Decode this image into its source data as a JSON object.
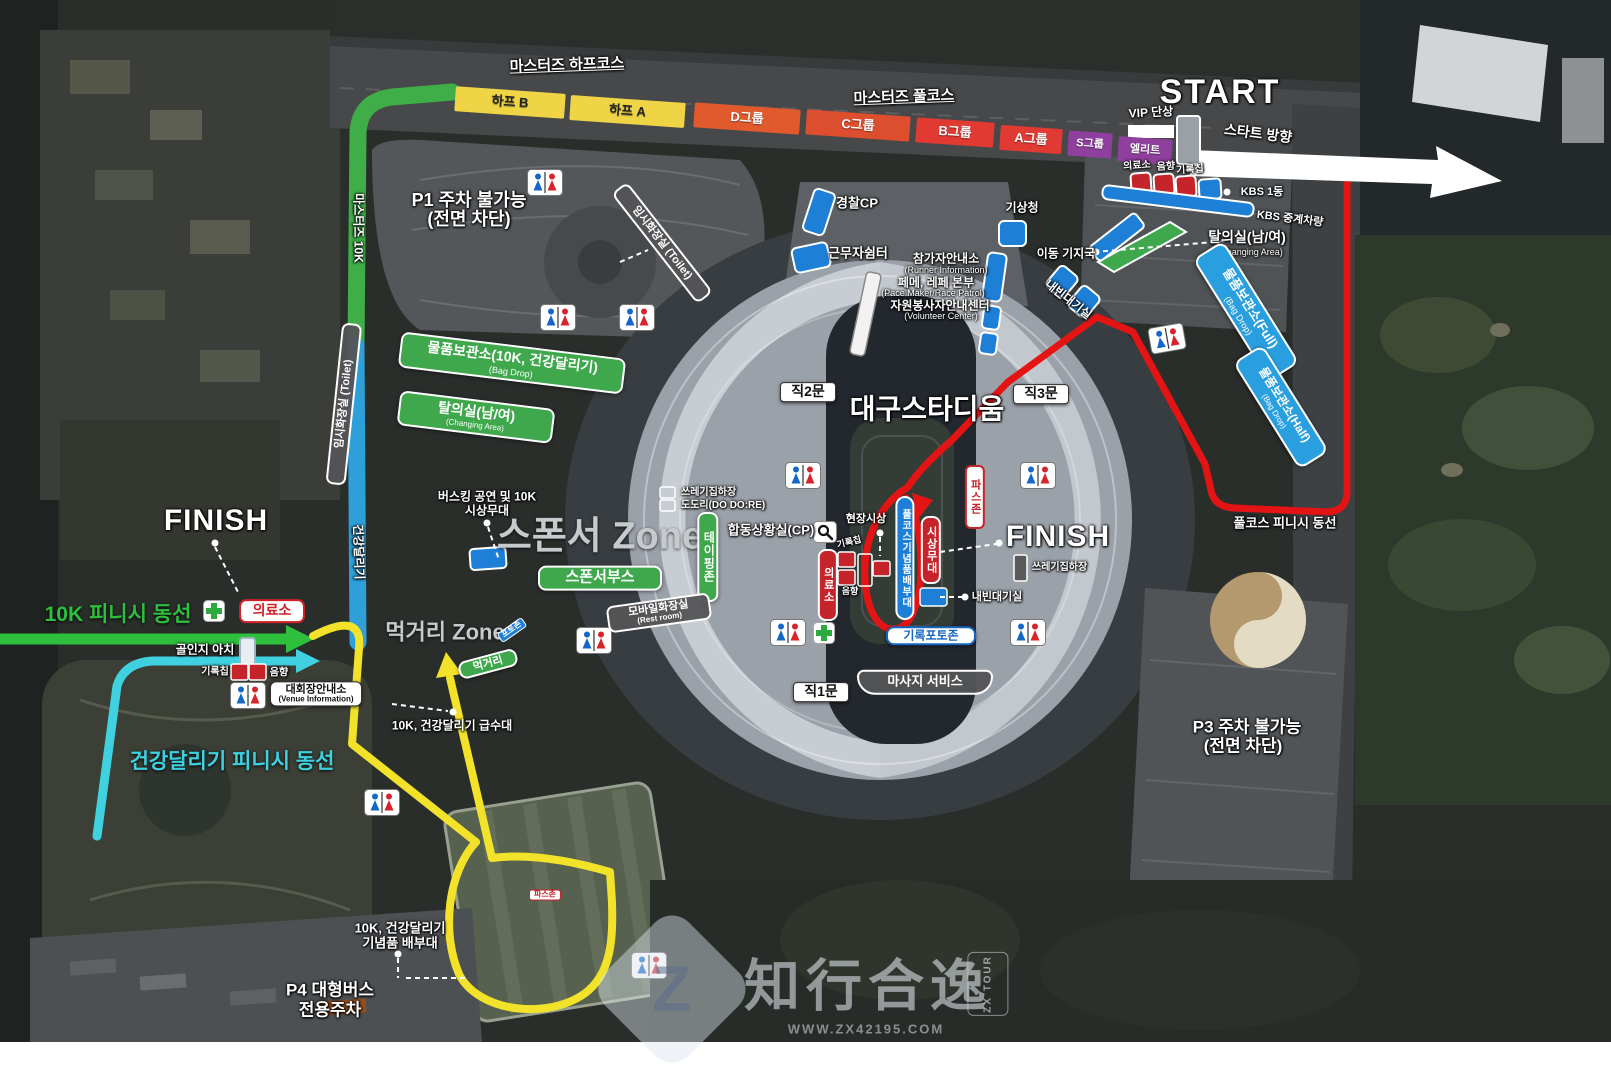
{
  "colors": {
    "course_green": "#3fae49",
    "course_blue": "#2e9fd8",
    "route_yellow": "#f2e32a",
    "route_cyan": "#3fd1e0",
    "route_red": "#e51414",
    "finish10k_green": "#2ebf3c",
    "bar_yellow": "#efd546",
    "bar_orange": "#e05a2d",
    "bar_red": "#e13a33",
    "bar_purple": "#8f3f9e",
    "box_blue": "#2a9fe0",
    "box_green": "#3fa84c",
    "box_red": "#c5242b"
  },
  "labels": {
    "masters_half": "마스터즈 하프코스",
    "masters_full": "마스터즈 풀코스",
    "half_b": "하프 B",
    "half_a": "하프 A",
    "grp_d": "D그룹",
    "grp_c": "C그룹",
    "grp_b": "B그룹",
    "grp_a": "A그룹",
    "grp_s": "S그룹",
    "elite": "엘리트",
    "vip": "VIP 단상",
    "start": "START",
    "start_dir": "스타트 방향",
    "medical": "의료소",
    "sound": "음향",
    "chip": "기록칩",
    "kbs1": "KBS 1동",
    "kbs_van": "KBS 중계차량",
    "changing": "탈의실(남/여)",
    "changing_en": "(Changing Area)",
    "bagdrop_full": "물품보관소(Full)",
    "bagdrop_half": "물품보관소(Half)",
    "bagdrop_en": "(Bag Drop)",
    "weather": "기상청",
    "mobile_base": "이동 기지국",
    "police": "경찰CP",
    "shelter": "근무자쉼터",
    "runner_info": "참가자안내소",
    "runner_info_en": "(Runner Information)",
    "pacer": "페메, 레페 본부",
    "pacer_en": "(Pace Maker/Race Patrol)",
    "volunteer": "자원봉사자안내센터",
    "volunteer_en": "(Volunteer Center)",
    "vip_lounge": "내빈대기실",
    "p1_1": "P1 주차 불가능",
    "p1_2": "(전면 차단)",
    "masters_10k": "마스터즈 10K",
    "health_run": "건강달리기",
    "temp_toilet": "임시화장실 (Toilet)",
    "bagdrop_10k": "물품보관소(10K, 건강달리기)",
    "busking_1": "버스킹 공연 및 10K",
    "busking_2": "시상무대",
    "sponsor_zone": "스폰서 Zone",
    "sponsor_booth": "스폰서부스",
    "taping": "테이핑존",
    "trash": "쓰레기집하장",
    "dodori": "도도리(DO DO:RE)",
    "joint_cp": "합동상황실(CP)",
    "gate1": "직1문",
    "gate2": "직2문",
    "gate3": "직3문",
    "stadium": "대구스타디움",
    "onsite_award": "현장시상",
    "full_souvenir": "풀코스기념품배부대",
    "award_stage": "시상무대",
    "pas_zone": "파스존",
    "finish": "FINISH",
    "record_photo": "기록포토존",
    "massage": "마사지 서비스",
    "finish_10k": "10K 피니시 동선",
    "finish_health": "건강달리기 피니시 동선",
    "finish_full": "풀코스 피니시 동선",
    "arch": "골인지 아치",
    "venue_info": "대회장안내소",
    "venue_info_en": "(Venue Information)",
    "food_zone": "먹거리 Zone",
    "food": "먹거리",
    "photo_zone": "포토존",
    "mobile_toilet": "모바일화장실",
    "mobile_toilet_en": "(Rest room)",
    "water": "10K, 건강달리기 급수대",
    "souvenir_1": "10K, 건강달리기",
    "souvenir_2": "기념품 배부대",
    "p4_1": "P4 대형버스",
    "p4_2": "전용주차",
    "p3_1": "P3 주차 불가능",
    "p3_2": "(전면 차단)"
  },
  "watermark": {
    "logo": "Z",
    "cn": "知行合逸",
    "url": "WWW.ZX42195.COM",
    "side": "ZX TOUR"
  }
}
